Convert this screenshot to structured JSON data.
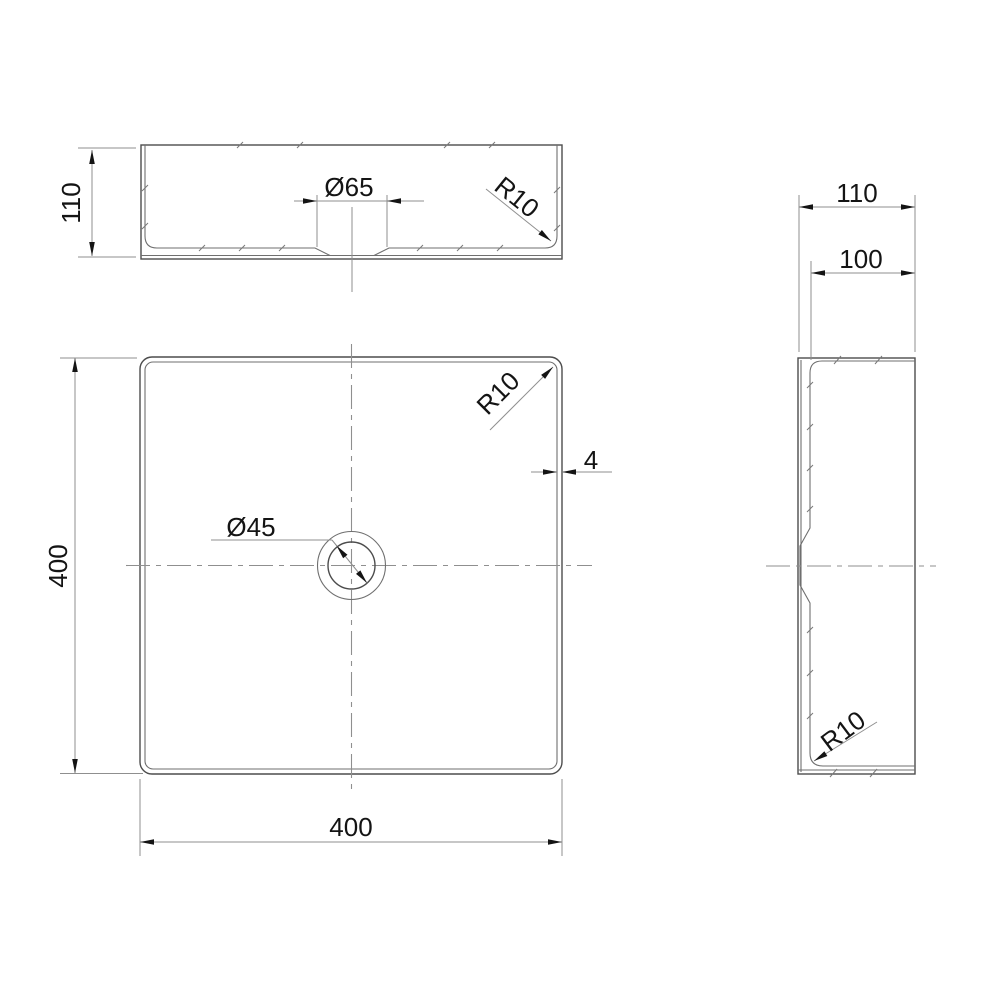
{
  "drawing": {
    "type": "orthographic technical drawing",
    "subject": "square vessel washbasin with central drain hole",
    "background": "#ffffff",
    "line_colors": {
      "object": "#4d4d4d",
      "dimension": "#8f8f8f",
      "annotation": "#141414"
    },
    "views": {
      "front": {
        "label": "front view",
        "dims": {
          "height": "110",
          "drain_recess_diameter": "Ø65",
          "corner_radius": "R10"
        }
      },
      "plan": {
        "label": "plan view",
        "dims": {
          "width": "400",
          "depth": "400",
          "hole_diameter": "Ø45",
          "corner_radius": "R10",
          "wall_thickness": "4"
        }
      },
      "side": {
        "label": "side view",
        "dims": {
          "overall_depth": "110",
          "inner_depth": "100",
          "corner_radius": "R10"
        }
      }
    }
  }
}
